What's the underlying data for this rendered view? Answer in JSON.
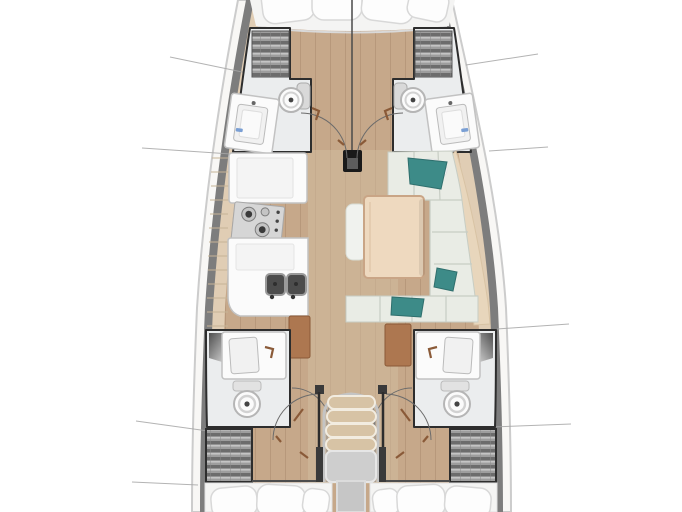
{
  "diagram": {
    "kind": "sailing-yacht-interior-floor-plan",
    "orientation": "bow-up",
    "regions": [
      "v-berth-bed",
      "port-forward-head",
      "starboard-forward-head",
      "galley",
      "salon-settee",
      "salon-table",
      "port-aft-head",
      "starboard-aft-head",
      "companionway-stairs",
      "port-aft-cabin-bed",
      "starboard-aft-cabin-bed"
    ]
  },
  "colors": {
    "page_bg": "#ffffff",
    "hull_fill": "#f8f7f5",
    "hull_outline": "#cccccc",
    "gunwale": "#7d7d7d",
    "deck_strip": "#e0cdb4",
    "floor_wood": "#c6a88a",
    "corridor_wood": "#d2bb9e",
    "room_floor": "#ebedee",
    "room_outline": "#2d2d2d",
    "fixture_white": "#fbfbfb",
    "fixture_stroke": "#c2c2c2",
    "basin_fill": "#f1f1f1",
    "shelf_slat_dark": "#6c6c6c",
    "shelf_base": "#9d9d9d",
    "cushion": "#e9ece5",
    "cushion_seam": "#c7cdc4",
    "backrest_tan": "#e8d6bc",
    "table_wood": "#eed9bf",
    "table_edge": "#c9a586",
    "teal": "#3d8b88",
    "cabinet_brown": "#ad7750",
    "door_brown": "#8a5a38",
    "arc_gray": "#6b6b6b",
    "stair_tread": "#d7c3a5",
    "stair_landing": "#cecece",
    "stair_runner": "#c6c6c6",
    "rail_chrome": "#c4c4c4",
    "bed_white": "#f4f4f3",
    "pillow_white": "#fdfdfd",
    "pillow_stroke": "#d8d8d8",
    "leader_line": "#a6a6a6",
    "mast_black": "#1a1a1a",
    "stove_steel": "#d6d6d6",
    "burner_dark": "#3a3a3a",
    "sink_dark": "#4c4c4c",
    "tile_line": "#c6b496",
    "shower_dark": "#5a5a5a"
  }
}
